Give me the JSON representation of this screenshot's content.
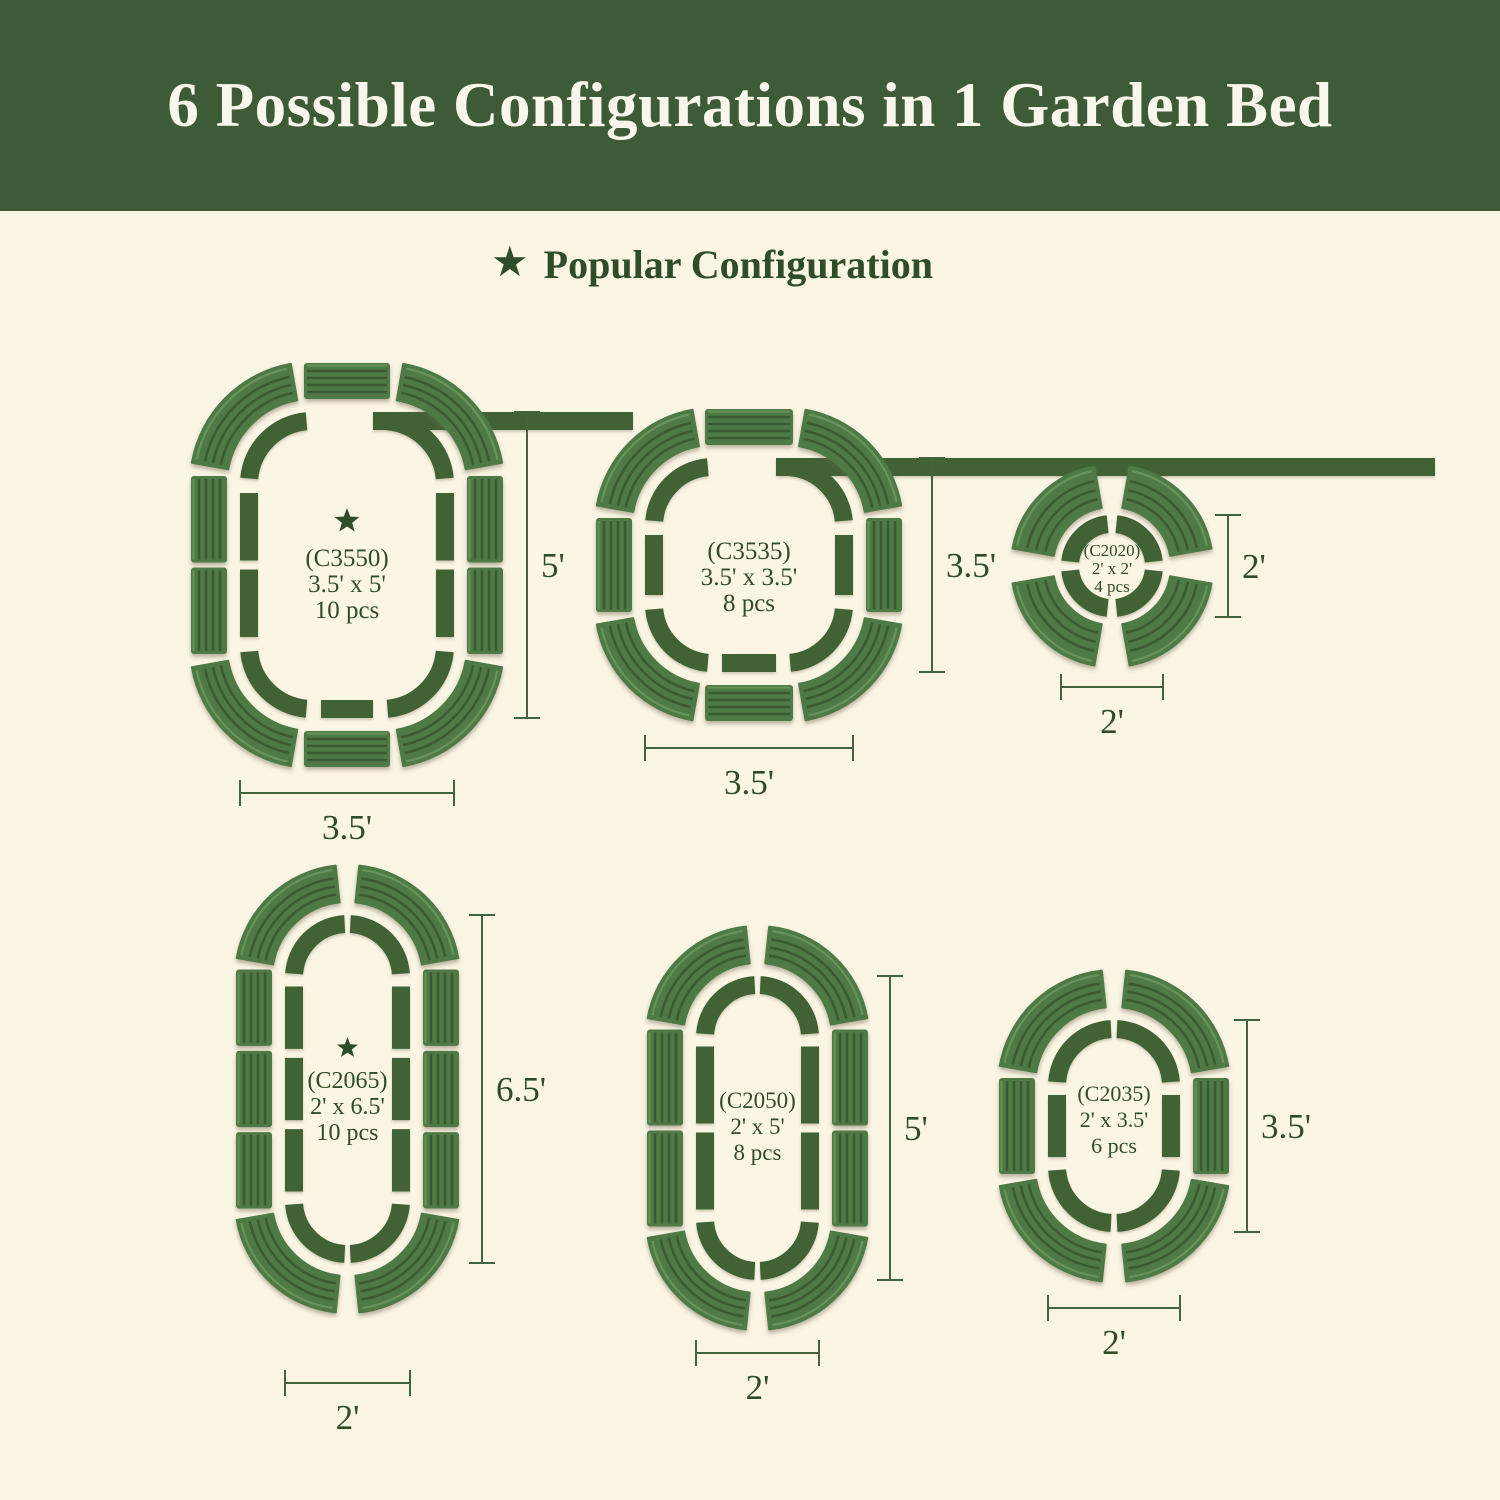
{
  "title": "6 Possible Configurations in 1 Garden Bed",
  "legend": {
    "label": "Popular Configuration",
    "star_glyph": "★"
  },
  "colors": {
    "banner": "#3e5b38",
    "background": "#fbf5e4",
    "outline": "#3f6236",
    "panel": "#4d7a45",
    "panel_ridge": "#3a5a32",
    "panel_highlight": "#6a935c",
    "text": "#2e4d28",
    "dimension_line": "#436240",
    "title_text": "#f9f7ec"
  },
  "configurations": [
    {
      "id": "C3550",
      "code": "(C3550)",
      "size": "3.5' x 5'",
      "pieces": "10 pcs",
      "popular": true,
      "width_label": "3.5'",
      "height_label": "5'",
      "shape": "roundrect",
      "corner_pieces": 4,
      "segments": {
        "left": 2,
        "right": 2,
        "top": 1,
        "bottom": 1
      }
    },
    {
      "id": "C3535",
      "code": "(C3535)",
      "size": "3.5' x 3.5'",
      "pieces": "8 pcs",
      "popular": false,
      "width_label": "3.5'",
      "height_label": "3.5'",
      "shape": "roundrect",
      "corner_pieces": 4,
      "segments": {
        "left": 1,
        "right": 1,
        "top": 1,
        "bottom": 1
      }
    },
    {
      "id": "C2020",
      "code": "(C2020)",
      "size": "2' x 2'",
      "pieces": "4 pcs",
      "popular": false,
      "width_label": "2'",
      "height_label": "2'",
      "shape": "circle",
      "corner_pieces": 4,
      "segments": {
        "left": 0,
        "right": 0,
        "top": 0,
        "bottom": 0
      }
    },
    {
      "id": "C2065",
      "code": "(C2065)",
      "size": "2' x 6.5'",
      "pieces": "10 pcs",
      "popular": true,
      "width_label": "2'",
      "height_label": "6.5'",
      "shape": "capsule",
      "corner_pieces": 4,
      "segments": {
        "left": 3,
        "right": 3,
        "top": 0,
        "bottom": 0
      }
    },
    {
      "id": "C2050",
      "code": "(C2050)",
      "size": "2' x 5'",
      "pieces": "8 pcs",
      "popular": false,
      "width_label": "2'",
      "height_label": "5'",
      "shape": "capsule",
      "corner_pieces": 4,
      "segments": {
        "left": 2,
        "right": 2,
        "top": 0,
        "bottom": 0
      }
    },
    {
      "id": "C2035",
      "code": "(C2035)",
      "size": "2' x 3.5'",
      "pieces": "6 pcs",
      "popular": false,
      "width_label": "2'",
      "height_label": "3.5'",
      "shape": "capsule",
      "corner_pieces": 4,
      "segments": {
        "left": 1,
        "right": 1,
        "top": 0,
        "bottom": 0
      }
    }
  ]
}
